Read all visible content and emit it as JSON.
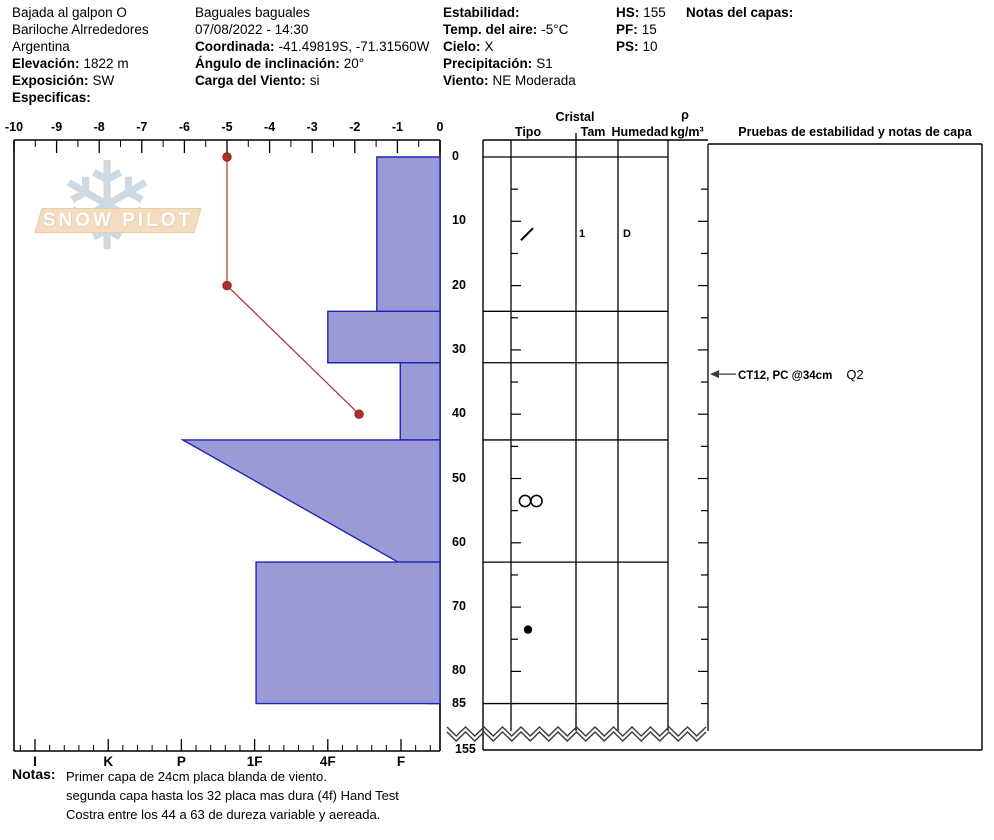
{
  "header": {
    "columns": [
      {
        "lines": [
          {
            "label": "",
            "value": "Bajada al galpon O"
          },
          {
            "label": "",
            "value": "Bariloche Alrrededores"
          },
          {
            "label": "",
            "value": "Argentina"
          },
          {
            "label": "Elevación:",
            "value": "1822 m"
          },
          {
            "label": "Exposición:",
            "value": "SW"
          },
          {
            "label": "Especificas:",
            "value": ""
          }
        ]
      },
      {
        "lines": [
          {
            "label": "",
            "value": "Baguales baguales"
          },
          {
            "label": "",
            "value": "07/08/2022 - 14:30"
          },
          {
            "label": "Coordinada:",
            "value": "-41.49819S, -71.31560W"
          },
          {
            "label": "Ángulo de inclinación:",
            "value": "20°"
          },
          {
            "label": "Carga del Viento:",
            "value": "si"
          }
        ]
      },
      {
        "lines": [
          {
            "label": "Estabilidad:",
            "value": ""
          },
          {
            "label": "Temp. del aire:",
            "value": "-5°C"
          },
          {
            "label": "Cielo:",
            "value": "X"
          },
          {
            "label": "Precipitación:",
            "value": "S1"
          },
          {
            "label": "Viento:",
            "value": "NE Moderada"
          }
        ]
      },
      {
        "lines": [
          {
            "label": "HS:",
            "value": "155"
          },
          {
            "label": "PF:",
            "value": "15"
          },
          {
            "label": "PS:",
            "value": "10"
          }
        ]
      },
      {
        "lines": [
          {
            "label": "Notas del capas:",
            "value": ""
          }
        ]
      }
    ]
  },
  "watermark": {
    "text": "SNOW PILOT"
  },
  "chart_data": {
    "type": "snow-profile",
    "title": "Snow pit hardness / temperature profile",
    "temp_axis": {
      "unit": "°C",
      "min": -10,
      "max": 0,
      "ticks": [
        -10,
        -9,
        -8,
        -7,
        -6,
        -5,
        -4,
        -3,
        -2,
        -1,
        0
      ]
    },
    "hardness_axis": {
      "categories": [
        "I",
        "K",
        "P",
        "1F",
        "4F",
        "F"
      ]
    },
    "depth_axis": {
      "unit": "cm",
      "labels": [
        0,
        10,
        20,
        30,
        40,
        50,
        60,
        70,
        80,
        85
      ],
      "break_label": "155",
      "total_height_cm": 155
    },
    "temperature_profile": [
      {
        "depth_cm": 0,
        "temp_c": -5
      },
      {
        "depth_cm": 20,
        "temp_c": -5
      },
      {
        "depth_cm": 40,
        "temp_c": -1.9
      }
    ],
    "layers": [
      {
        "top_cm": 0,
        "bottom_cm": 24,
        "hardness_top": 4.67,
        "hardness_bottom": 4.67,
        "hardness_label": "4F-F"
      },
      {
        "top_cm": 24,
        "bottom_cm": 32,
        "hardness_top": 4.0,
        "hardness_bottom": 4.0,
        "hardness_label": "4F"
      },
      {
        "top_cm": 32,
        "bottom_cm": 44,
        "hardness_top": 4.99,
        "hardness_bottom": 4.99,
        "hardness_label": "F"
      },
      {
        "top_cm": 44,
        "bottom_cm": 63,
        "hardness_top": 2.02,
        "hardness_bottom": 4.96,
        "hardness_label": "P to F (variable)"
      },
      {
        "top_cm": 63,
        "bottom_cm": 85,
        "hardness_top": 3.02,
        "hardness_bottom": 3.02,
        "hardness_label": "1F"
      }
    ],
    "grains": [
      {
        "depth_cm": 12,
        "type_symbol": "slash-decomposing-fragments",
        "size": "1",
        "humidity": "D"
      },
      {
        "depth_cm": 53.5,
        "type_symbol": "double-circle-melt-freeze",
        "size": "",
        "humidity": ""
      },
      {
        "depth_cm": 73.5,
        "type_symbol": "dot-rounded-grains",
        "size": "",
        "humidity": ""
      }
    ],
    "tests": [
      {
        "depth_cm": 34,
        "label": "CT12, PC @34cm",
        "shear_quality": "Q2"
      }
    ]
  },
  "table": {
    "group_header": "Cristal",
    "col_tipo": "Tipo",
    "col_tam": "Tam",
    "col_humedad": "Humedad",
    "density_rho": "ρ",
    "density_unit": "kg/m³",
    "tests_header": "Pruebas de estabilidad y notas de capa"
  },
  "notes": {
    "label": "Notas:",
    "lines": [
      "Primer capa de 24cm placa blanda de viento.",
      "segunda capa hasta los 32 placa mas dura  (4f) Hand Test",
      "Costra entre los 44 a 63 de dureza variable y aereada."
    ]
  },
  "colors": {
    "bar_fill": "#9a9ad6",
    "bar_stroke": "#2323b8",
    "temp_line": "#a93333",
    "temp_dot": "#b03030",
    "axis": "#000000",
    "zigzag": "#3a3a3a",
    "logo_snowflake": "#cdd9e3",
    "logo_banner": "#f4dcc1",
    "logo_text": "#ffffff"
  }
}
